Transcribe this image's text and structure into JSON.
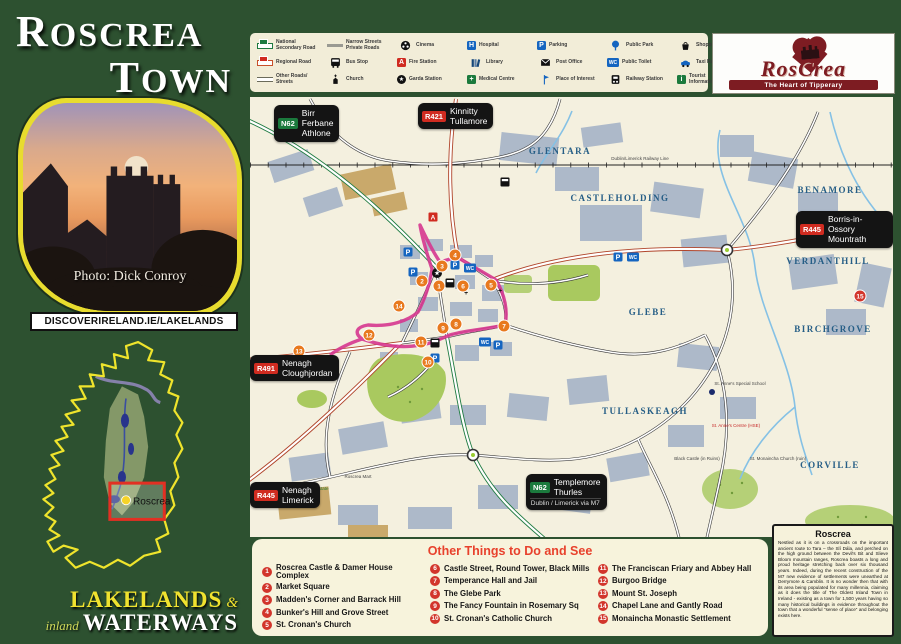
{
  "sidebar": {
    "title_line1": "Roscrea",
    "title_line2": "Town",
    "photo_credit": "Photo: Dick Conroy",
    "website": "DISCOVERIRELAND.IE/LAKELANDS",
    "inset_label": "Roscrea",
    "brand_line1": "Lakelands",
    "brand_amp": "&",
    "brand_line2a": "inland",
    "brand_line2b": "Waterways"
  },
  "logo": {
    "name": "RosCrea",
    "tagline": "The Heart of Tipperary"
  },
  "legend": {
    "items": [
      {
        "label": "National Secondary Road"
      },
      {
        "label": "Regional Road"
      },
      {
        "label": "Other Roads/ Streets"
      },
      {
        "label": "Narrow Streets Private Roads"
      },
      {
        "label": "Bus Stop"
      },
      {
        "label": "Church"
      },
      {
        "label": "Cinema"
      },
      {
        "label": "Fire Station"
      },
      {
        "label": "Garda Station"
      },
      {
        "label": "Hospital"
      },
      {
        "label": "Library"
      },
      {
        "label": "Medical Centre"
      },
      {
        "label": "Parking"
      },
      {
        "label": "Post Office"
      },
      {
        "label": "Place of Interest"
      },
      {
        "label": "Public Park"
      },
      {
        "label": "Public Toilet"
      },
      {
        "label": "Railway Station"
      },
      {
        "label": "Shopping Centre"
      },
      {
        "label": "Taxi Rank"
      },
      {
        "label": "Tourist Information"
      }
    ],
    "glyphs": {
      "hospital": "H",
      "parking": "P",
      "wc": "WC",
      "medical": "+",
      "fire": "A",
      "garda": "★",
      "tourist": "i"
    }
  },
  "map": {
    "signs": [
      {
        "badge": "N62",
        "dest": "Birr\nFerbane\nAthlone"
      },
      {
        "badge": "R421",
        "dest": "Kinnitty\nTullamore"
      },
      {
        "badge": "R445",
        "dest": "Borris-in-Ossory\nMountrath"
      },
      {
        "badge": "R491",
        "dest": "Nenagh\nCloughjordan"
      },
      {
        "badge": "R445",
        "dest": "Nenagh\nLimerick"
      },
      {
        "badge": "N62",
        "dest": "Templemore\nThurles",
        "footer": "Dublin / Limerick via M7"
      }
    ],
    "districts": [
      "GLENTARA",
      "CASTLEHOLDING",
      "BENAMORE",
      "VERDANTHILL",
      "GLEBE",
      "BIRCHGROVE",
      "TULLASKEAGH",
      "CORVILLE"
    ],
    "railway_label": "Dublin/Limerick Railway Line",
    "small_labels": {
      "industrial": "Parkmore Industrial Estate",
      "mart": "Roscrea Mart",
      "school": "St. Anne's Special School",
      "hse": "St. Anne's Centre (HSE)",
      "castle": "Black Castle (in Ruins)",
      "church": "St. Monaincha Church (ruin)"
    },
    "marker_numbers": [
      "1",
      "2",
      "3",
      "4",
      "5",
      "6",
      "7",
      "8",
      "9",
      "10",
      "11",
      "12",
      "13",
      "14",
      "15"
    ],
    "icon_glyphs": {
      "parking": "P",
      "wc": "WC",
      "star": "★",
      "cross": "+",
      "fire": "A"
    }
  },
  "poi": {
    "title": "Other Things to Do and See",
    "items": [
      {
        "n": "1",
        "t": "Roscrea Castle & Damer House Complex"
      },
      {
        "n": "2",
        "t": "Market Square"
      },
      {
        "n": "3",
        "t": "Madden's Corner and Barrack Hill"
      },
      {
        "n": "4",
        "t": "Bunker's Hill and Grove Street"
      },
      {
        "n": "5",
        "t": "St. Cronan's Church"
      },
      {
        "n": "6",
        "t": "Castle Street, Round Tower, Black Mills"
      },
      {
        "n": "7",
        "t": "Temperance Hall and Jail"
      },
      {
        "n": "8",
        "t": "The Glebe Park"
      },
      {
        "n": "9",
        "t": "The Fancy Fountain in Rosemary Sq"
      },
      {
        "n": "10",
        "t": "St. Cronan's Catholic Church"
      },
      {
        "n": "11",
        "t": "The Franciscan Friary and Abbey Hall"
      },
      {
        "n": "12",
        "t": "Burgoo Bridge"
      },
      {
        "n": "13",
        "t": "Mount St. Joseph"
      },
      {
        "n": "14",
        "t": "Chapel Lane and Gantly Road"
      },
      {
        "n": "15",
        "t": "Monaincha Monastic Settlement"
      }
    ]
  },
  "info": {
    "title": "Roscrea",
    "body": "Nestled as it is on a crossroads on the important ancient route to Tara – the Slí Dála, and perched on the high ground between the Devil's Bit and Slieve Bloom mountain ranges, Roscrea boasts a long and proud heritage stretching back over six thousand years. Indeed, during the recent construction of the M7 new evidence of settlements were unearthed at Derrymore & Camblin. It is no wonder then that with its area being populated for many millennia, claiming as it does the title of The Oldest Inland Town in Ireland - existing as a town for 1,500 years having so many historical buildings in evidence throughout the town that a wonderful “sense of place” and belonging exists here."
  }
}
